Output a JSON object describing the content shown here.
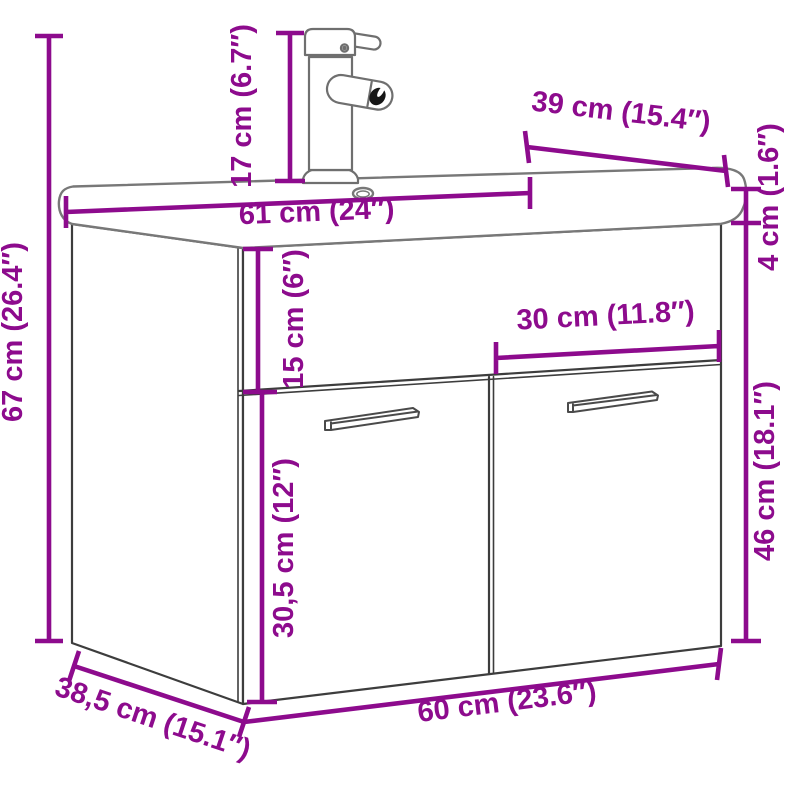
{
  "diagram": {
    "dimensions": {
      "total_height": "67 cm (26.4″)",
      "faucet_height": "17 cm (6.7″)",
      "basin_depth": "39 cm (15.4″)",
      "basin_width": "61 cm (24″)",
      "basin_height": "4 cm (1.6″)",
      "top_panel_height": "15 cm (6″)",
      "door_width": "30 cm (11.8″)",
      "door_height": "46 cm (18.1″)",
      "lower_panel_height": "30,5 cm (12″)",
      "cabinet_depth": "38,5 cm (15.1″)",
      "cabinet_width": "60 cm (23.6″)"
    },
    "colors": {
      "dimension_accent": "#8d0b8d",
      "cabinet_line": "#3d3d3d",
      "ceramic_line": "#787878",
      "background": "#ffffff"
    }
  }
}
